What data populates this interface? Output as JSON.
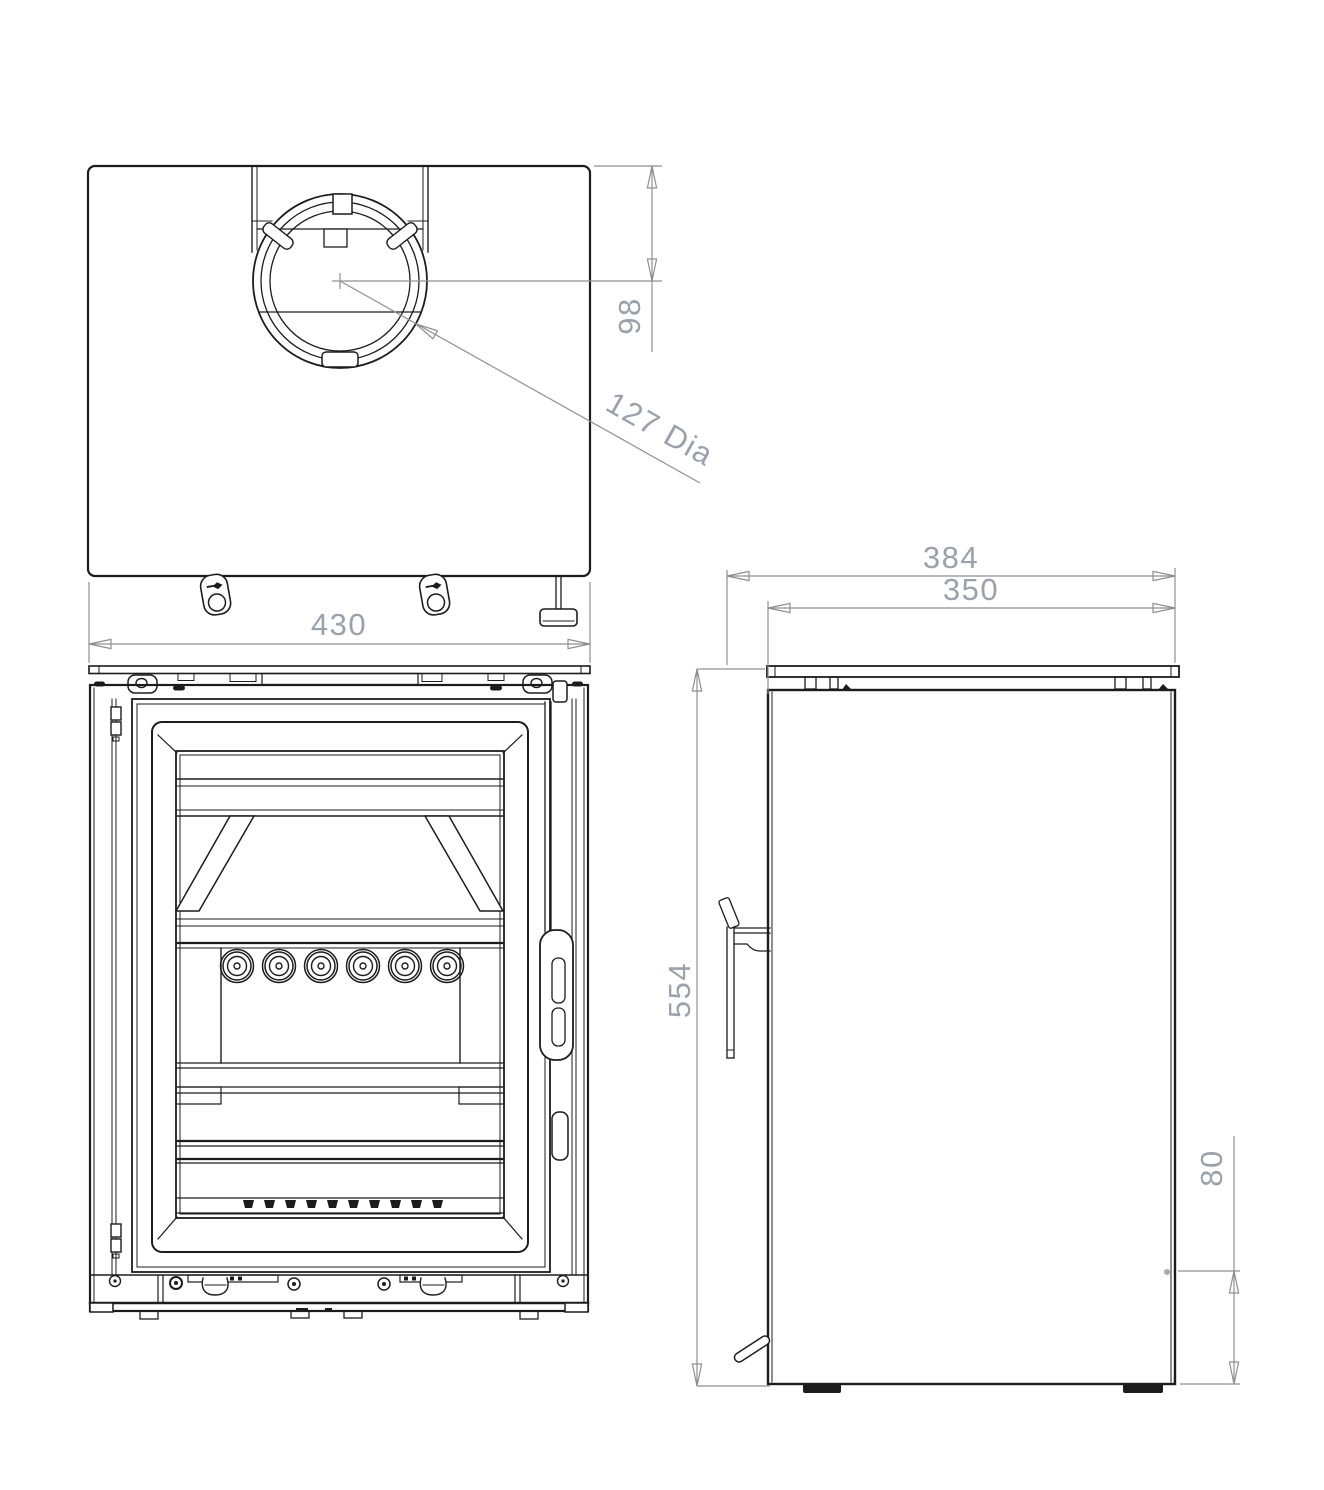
{
  "drawing": {
    "background": "#ffffff",
    "colors": {
      "object_line": "#1c1c1c",
      "dimension_line": "#8f8f8f",
      "dimension_text": "#99a1ab"
    },
    "dimensions": {
      "width": "430",
      "flue_center_from_rear": "98",
      "flue_diameter": "127 Dia",
      "depth_overall": "384",
      "depth_body": "350",
      "height": "554",
      "rear_outlet_height": "80"
    }
  }
}
